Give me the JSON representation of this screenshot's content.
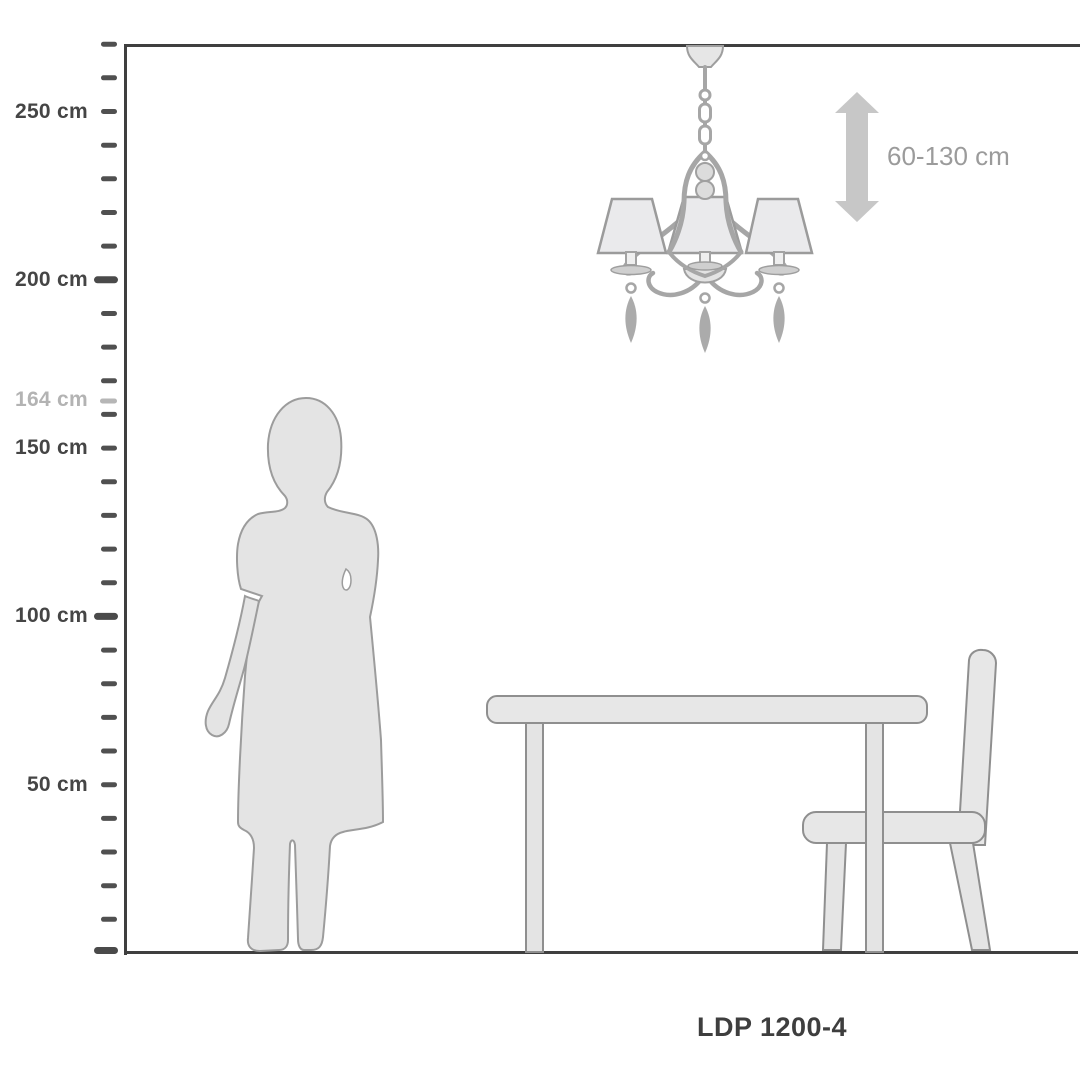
{
  "diagram": {
    "product_code": "LDP 1200-4",
    "height_range_label": "60-130 cm",
    "ruler": {
      "unit": "cm",
      "max_value_cm": 270,
      "tick_step_cm": 10,
      "labels": [
        {
          "text": "250 cm",
          "value_cm": 250,
          "muted": false
        },
        {
          "text": "200 cm",
          "value_cm": 200,
          "muted": false
        },
        {
          "text": "164 cm",
          "value_cm": 164,
          "muted": true
        },
        {
          "text": "150 cm",
          "value_cm": 150,
          "muted": false
        },
        {
          "text": "100 cm",
          "value_cm": 100,
          "muted": false
        },
        {
          "text": "50 cm",
          "value_cm": 50,
          "muted": false
        }
      ]
    },
    "scene": {
      "person_height_cm": 164,
      "objects": [
        "person silhouette",
        "chandelier with three shades",
        "dining table",
        "chair"
      ]
    },
    "colors": {
      "background": "#ffffff",
      "frame": "#3f3f3f",
      "tick": "#4f4f4f",
      "label_dark": "#454545",
      "label_muted": "#b3b3b3",
      "silhouette_fill": "#e4e4e4",
      "silhouette_stroke": "#9c9c9c",
      "furniture_fill": "#e7e7e7",
      "furniture_stroke": "#8f8f8f",
      "chandelier_metal": "#a6a6a6",
      "shade_fill": "#eaeaec",
      "arrow": "#c7c7c7",
      "range_text": "#9b9b9b",
      "product_code_text": "#3e3e3e"
    }
  }
}
